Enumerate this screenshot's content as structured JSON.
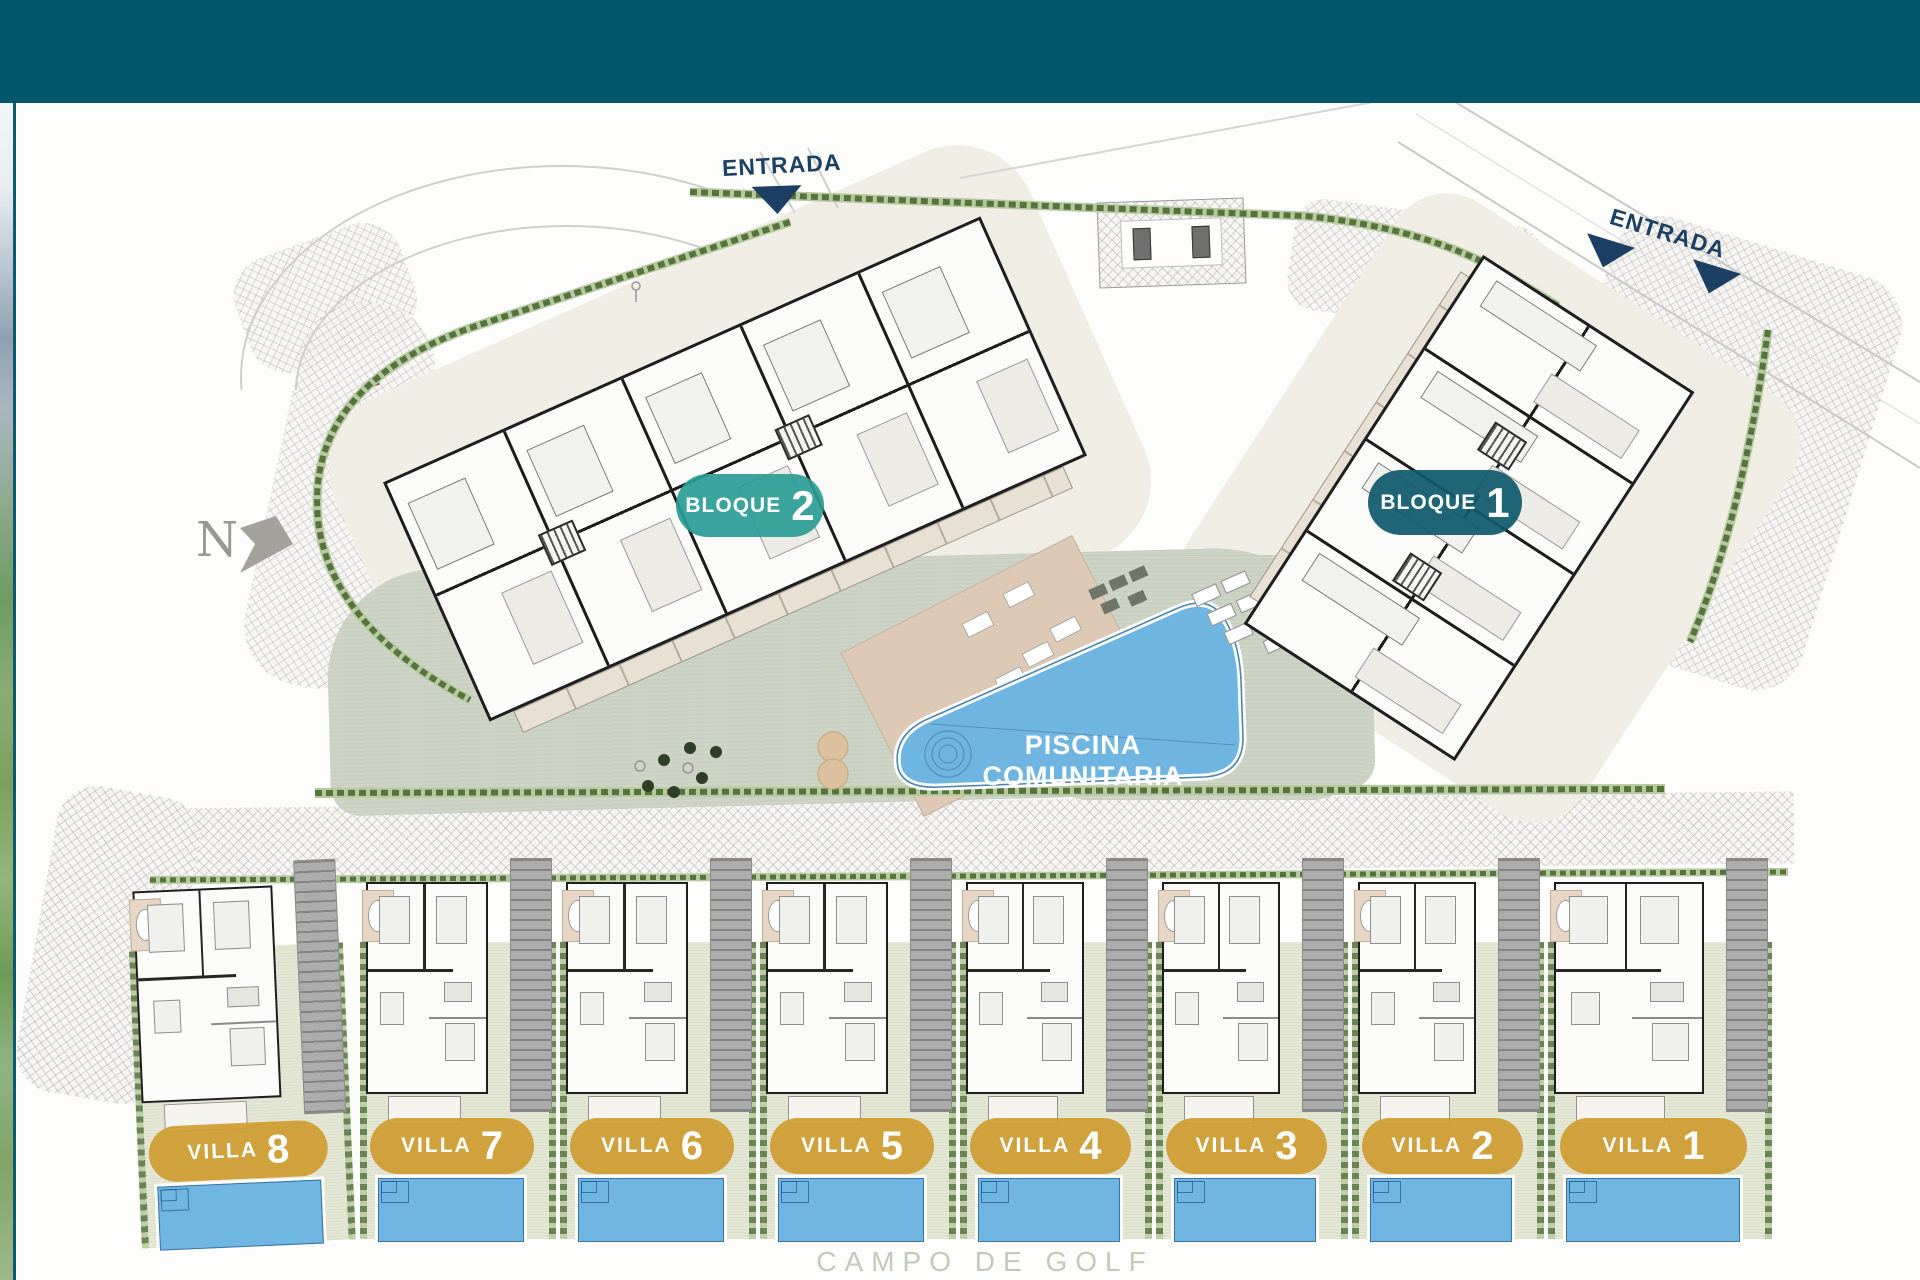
{
  "header": {
    "bar_color": "#04566A"
  },
  "plan": {
    "entrances": [
      {
        "label": "ENTRADA"
      },
      {
        "label": "ENTRADA"
      }
    ],
    "compass_label": "N",
    "badges": {
      "bloque2": {
        "label": "BLOQUE",
        "number": "2",
        "color": "#2A9C96"
      },
      "bloque1": {
        "label": "BLOQUE",
        "number": "1",
        "color": "#105A6C"
      }
    },
    "pool_label": "PISCINA COMUNITARIA",
    "villas": [
      {
        "label": "VILLA",
        "number": "8"
      },
      {
        "label": "VILLA",
        "number": "7"
      },
      {
        "label": "VILLA",
        "number": "6"
      },
      {
        "label": "VILLA",
        "number": "5"
      },
      {
        "label": "VILLA",
        "number": "4"
      },
      {
        "label": "VILLA",
        "number": "3"
      },
      {
        "label": "VILLA",
        "number": "2"
      },
      {
        "label": "VILLA",
        "number": "1"
      }
    ],
    "bottom_label": "CAMPO DE GOLF",
    "colors": {
      "villa_gold": "#CF9C30",
      "pool_blue": "#6FB6E3",
      "courtyard_green": "#CDD4C5",
      "entrance_navy": "#1C4063"
    }
  }
}
